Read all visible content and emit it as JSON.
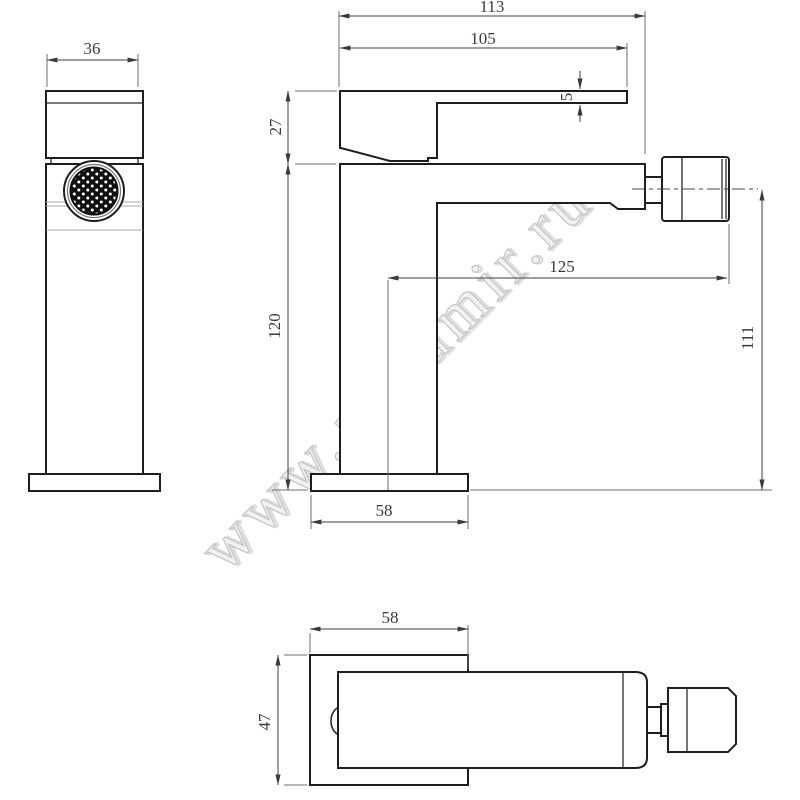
{
  "watermark": {
    "text": "www.aquamir.ru"
  },
  "dims": {
    "front_width": "36",
    "total_length": "113",
    "handle_length": "105",
    "handle_height": "27",
    "lever_thickness": "5",
    "body_height": "120",
    "spout_reach": "125",
    "outlet_height": "111",
    "base_depth_side": "58",
    "base_depth_top": "58",
    "base_width_top": "47"
  },
  "colors": {
    "background": "#ffffff",
    "outline": "#1e1e1e",
    "dimension": "#3f3f3f",
    "extension": "#6f6f6f",
    "watermark": "#e9e9e9",
    "aerator_mesh": "#101010"
  }
}
